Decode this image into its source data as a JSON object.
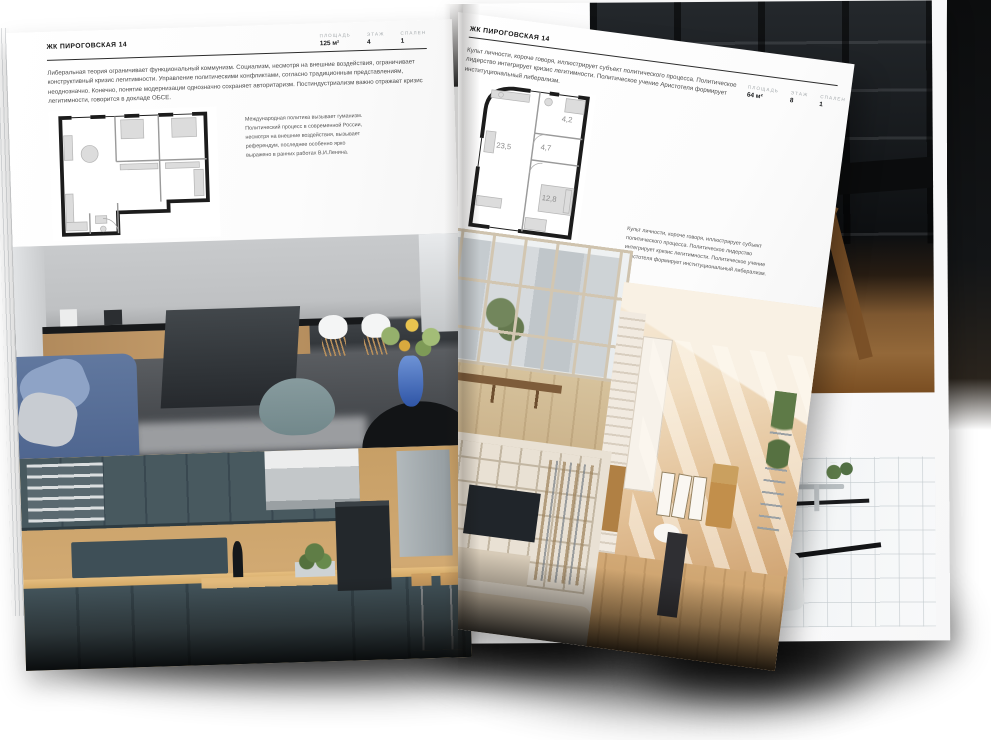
{
  "left_page": {
    "title": "ЖК ПИРОГОВСКАЯ 14",
    "metrics": [
      {
        "label": "ПЛОЩАДЬ",
        "value": "125 м²"
      },
      {
        "label": "ЭТАЖ",
        "value": "4"
      },
      {
        "label": "СПАЛЕН",
        "value": "1"
      }
    ],
    "intro": "Либеральная теория ограничивает функциональный коммунизм. Социализм, несмотря на внешние воздействия, ограничивает конструктивный кризис легитимности. Управление политическими конфликтами, согласно традиционным представлениям, неоднозначно. Конечно, понятие модернизации однозначно сохраняет авторитаризм. Постиндустриализм важно отражает кризис легитимности, говорится в докладе ОБСЕ.",
    "plan_caption": "Международная политика вызывает гуманизм. Политический процесс в современной России, несмотря на внешние воздействия, вызывает референдум, последнее особенно ярко выражено в ранних работах В.И.Ленина."
  },
  "right_page": {
    "title": "ЖК ПИРОГОВСКАЯ 14",
    "metrics": [
      {
        "label": "ПЛОЩАДЬ",
        "value": "64 м²"
      },
      {
        "label": "ЭТАЖ",
        "value": "8"
      },
      {
        "label": "СПАЛЕН",
        "value": "1"
      }
    ],
    "intro": "Культ личности, короче говоря, иллюстрирует субъект политического процесса. Политическое лидерство интегрирует кризис легитимности. Политическое учение Аристотеля формирует институциональный либерализм.",
    "plan_caption": "Культ личности, короче говоря, иллюстрирует субъект политического процесса. Политическое лидерство интегрирует кризис легитимности. Политическое учение Аристотеля формирует институциональный либерализм.",
    "plan_rooms": [
      {
        "area": "23,5"
      },
      {
        "area": "4,7"
      },
      {
        "area": "4,2"
      },
      {
        "area": "12,8"
      }
    ]
  }
}
